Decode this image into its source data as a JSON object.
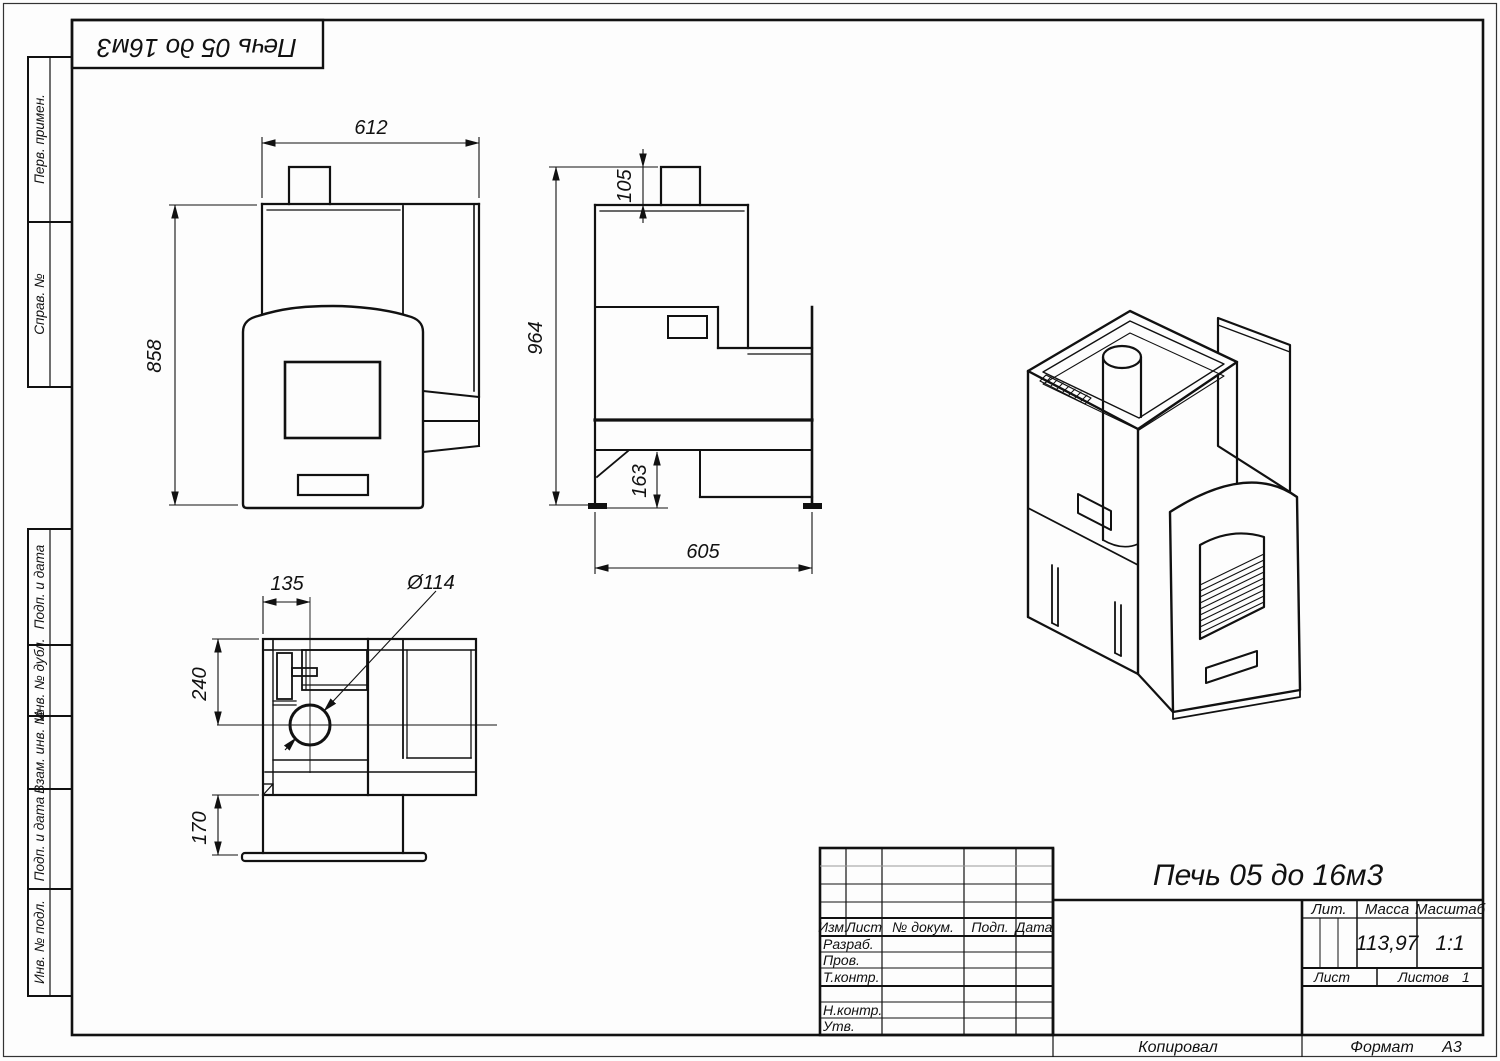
{
  "corner_stamp": {
    "title": "Печь 05 до 16м3"
  },
  "margin_labels": {
    "perv_primen": "Перв. примен.",
    "sprav_no": "Справ. №",
    "podp_data_1": "Подп. и дата",
    "inv_dubl": "Инв. № дубл.",
    "vzam_inv": "Взам. инв. №",
    "podp_data_2": "Подп. и дата",
    "inv_podl": "Инв. № подл."
  },
  "title_block": {
    "title": "Печь 05 до 16м3",
    "col_izm": "Изм.",
    "col_list": "Лист",
    "col_dokum": "№ докум.",
    "col_podp": "Подп.",
    "col_data": "Дата",
    "row_razrab": "Разраб.",
    "row_prov": "Пров.",
    "row_tkontr": "Т.контр.",
    "row_nkontr": "Н.контр.",
    "row_utv": "Утв.",
    "lit_label": "Лит.",
    "massa_label": "Масса",
    "masshtab_label": "Масштаб",
    "massa_value": "113,97",
    "masshtab_value": "1:1",
    "list_label": "Лист",
    "listov_label": "Листов",
    "listov_value": "1"
  },
  "footer": {
    "kopiroval": "Копировал",
    "format_label": "Формат",
    "format_value": "А3"
  },
  "dimensions": {
    "front_width": "612",
    "front_height": "858",
    "side_chimney": "105",
    "side_height": "964",
    "side_base": "163",
    "side_depth": "605",
    "plan_offset": "135",
    "plan_diameter": "Ø114",
    "plan_upper": "240",
    "plan_lower": "170"
  }
}
